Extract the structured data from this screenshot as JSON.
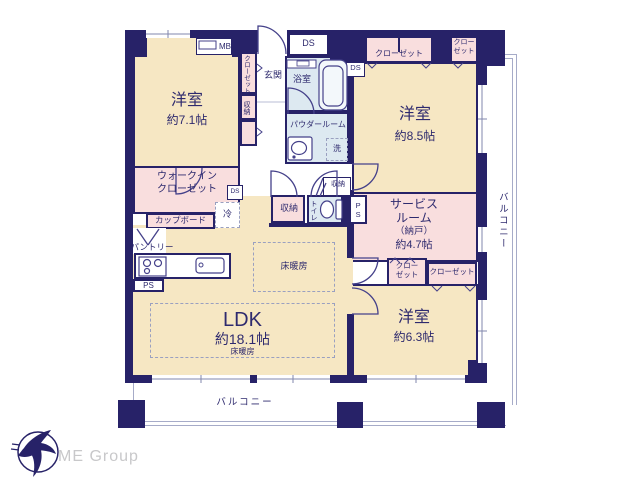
{
  "rooms": {
    "bedroom1": {
      "name": "洋室",
      "size": "約7.1帖"
    },
    "bedroom2": {
      "name": "洋室",
      "size": "約8.5帖"
    },
    "bedroom3": {
      "name": "洋室",
      "size": "約6.3帖"
    },
    "ldk": {
      "name": "LDK",
      "size": "約18.1帖"
    },
    "service_room": {
      "line1": "サービス",
      "line2": "ルーム",
      "line3": "（納戸）",
      "size": "約4.7帖"
    },
    "walk_in_closet": {
      "line1": "ウォークイン",
      "line2": "クローゼット"
    },
    "genkan": {
      "name": "玄関"
    },
    "bathroom": {
      "name": "浴室"
    },
    "powder_room": {
      "name": "パウダールーム"
    },
    "toilet": {
      "name": "トイレ"
    }
  },
  "features": {
    "closet": "クローゼット",
    "closet_line1": "クロー",
    "closet_line2": "ゼット",
    "storage": "収納",
    "cupboard": "カップボード",
    "pantry": "パントリー",
    "fridge": "冷",
    "washer": "洗",
    "floor_heating": "床暖房",
    "balcony": "バルコニー",
    "meter_box": "MB",
    "duct_space": "DS",
    "pipe_space": "PS"
  },
  "logo": {
    "company": "ME Group"
  },
  "colors": {
    "wall": "#272268",
    "room_fill": "#f6e7c3",
    "closet_fill": "#f9dede",
    "wet_area_fill": "#dde9f1",
    "balcony_line": "#a6abc8",
    "logo_text": "#c8c8ca"
  }
}
